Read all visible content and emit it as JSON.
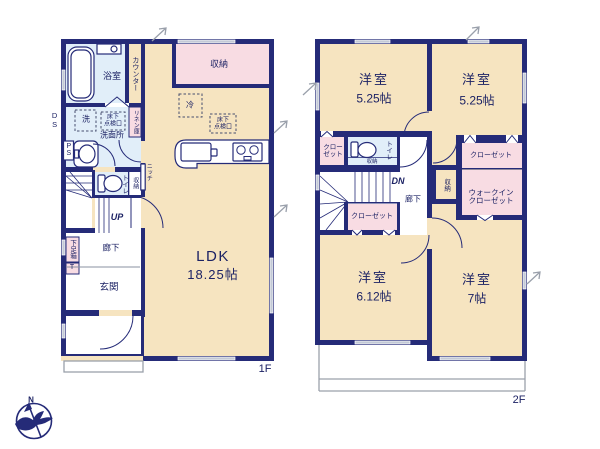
{
  "colors": {
    "wall": "#252b78",
    "room_cream": "#f6e4c0",
    "closet_pink": "#f8dce3",
    "wet_blue": "#e1eef9",
    "window_gray": "#c3c9d6",
    "text_navy": "#1c2264",
    "outline_gray": "#9aa0ab"
  },
  "floor1": {
    "floor_label": "1F",
    "bath": "浴室",
    "counter": "カウンター",
    "storage": "収納",
    "fridge": "冷",
    "underfloor_kitchen": "床下\n点検口",
    "underfloor_wash": "床下\n点検口",
    "washer": "洗",
    "washroom": "洗面所",
    "linen": "リネン庫",
    "duct": "DS",
    "pipe": "PS",
    "toilet": "トイレ",
    "toilet_storage": "収納",
    "niche": "ニッチ",
    "up": "UP",
    "shoe_box": "下足箱",
    "shoe_box_t": "T",
    "hallway": "廊下",
    "entrance": "玄関",
    "ldk_name": "LDK",
    "ldk_size": "18.25帖"
  },
  "floor2": {
    "floor_label": "2F",
    "room_nw": {
      "name": "洋室",
      "size": "5.25帖"
    },
    "room_ne": {
      "name": "洋室",
      "size": "5.25帖"
    },
    "room_sw": {
      "name": "洋室",
      "size": "6.12帖"
    },
    "room_se": {
      "name": "洋室",
      "size": "7帖"
    },
    "closet_west": "クロー\nゼット",
    "toilet": "トイレ",
    "toilet_storage": "収納",
    "down": "DN",
    "hallway": "廊下",
    "closet_under_stairs": "クローゼット",
    "storage_mid": "収納",
    "closet_east": "クローゼット",
    "walk_in_closet": "ウォークイン\nクローゼット"
  },
  "compass": {
    "north_label": "N"
  }
}
